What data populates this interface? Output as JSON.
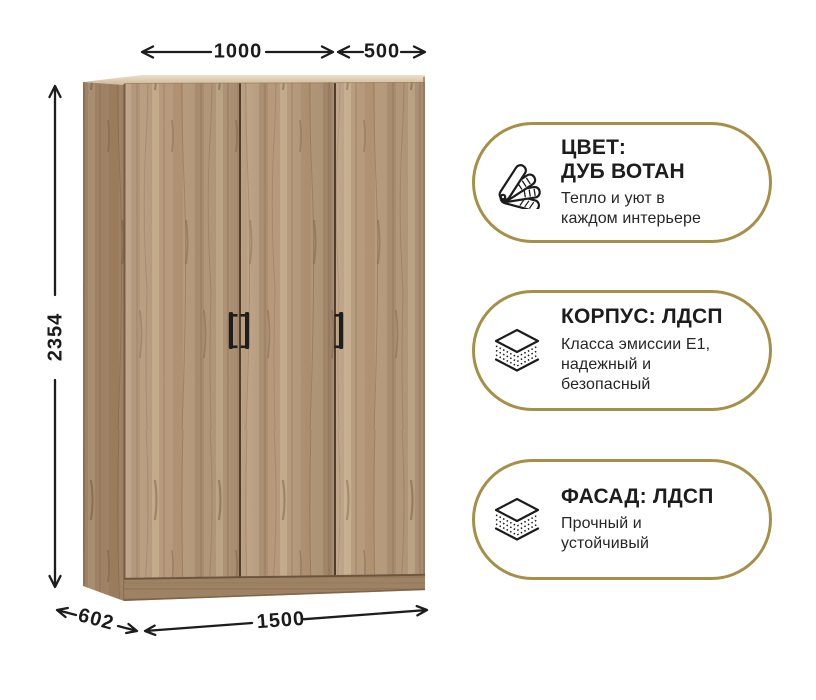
{
  "dimensions": {
    "top_section_width": "1000",
    "top_right_section_width": "500",
    "height": "2354",
    "depth": "602",
    "total_width": "1500"
  },
  "badges": [
    {
      "icon": "color-swatches-icon",
      "title": "ЦВЕТ:\nДУБ ВОТАН",
      "subtitle": "Тепло и уют в\nкаждом интерьере"
    },
    {
      "icon": "layers-icon",
      "title": "КОРПУС: ЛДСП",
      "subtitle": "Класса эмиссии Е1,\nнадежный и\nбезопасный"
    },
    {
      "icon": "layers-icon",
      "title": "ФАСАД: ЛДСП",
      "subtitle": "Прочный и\nустойчивый"
    }
  ],
  "colors": {
    "accent_gold": "#a69048",
    "text_dark": "#1c1c1c",
    "wood_door": "#b79a7c",
    "wood_side_shade": "#8a6c50",
    "handle_black": "#1e1e1e",
    "background": "#ffffff"
  }
}
